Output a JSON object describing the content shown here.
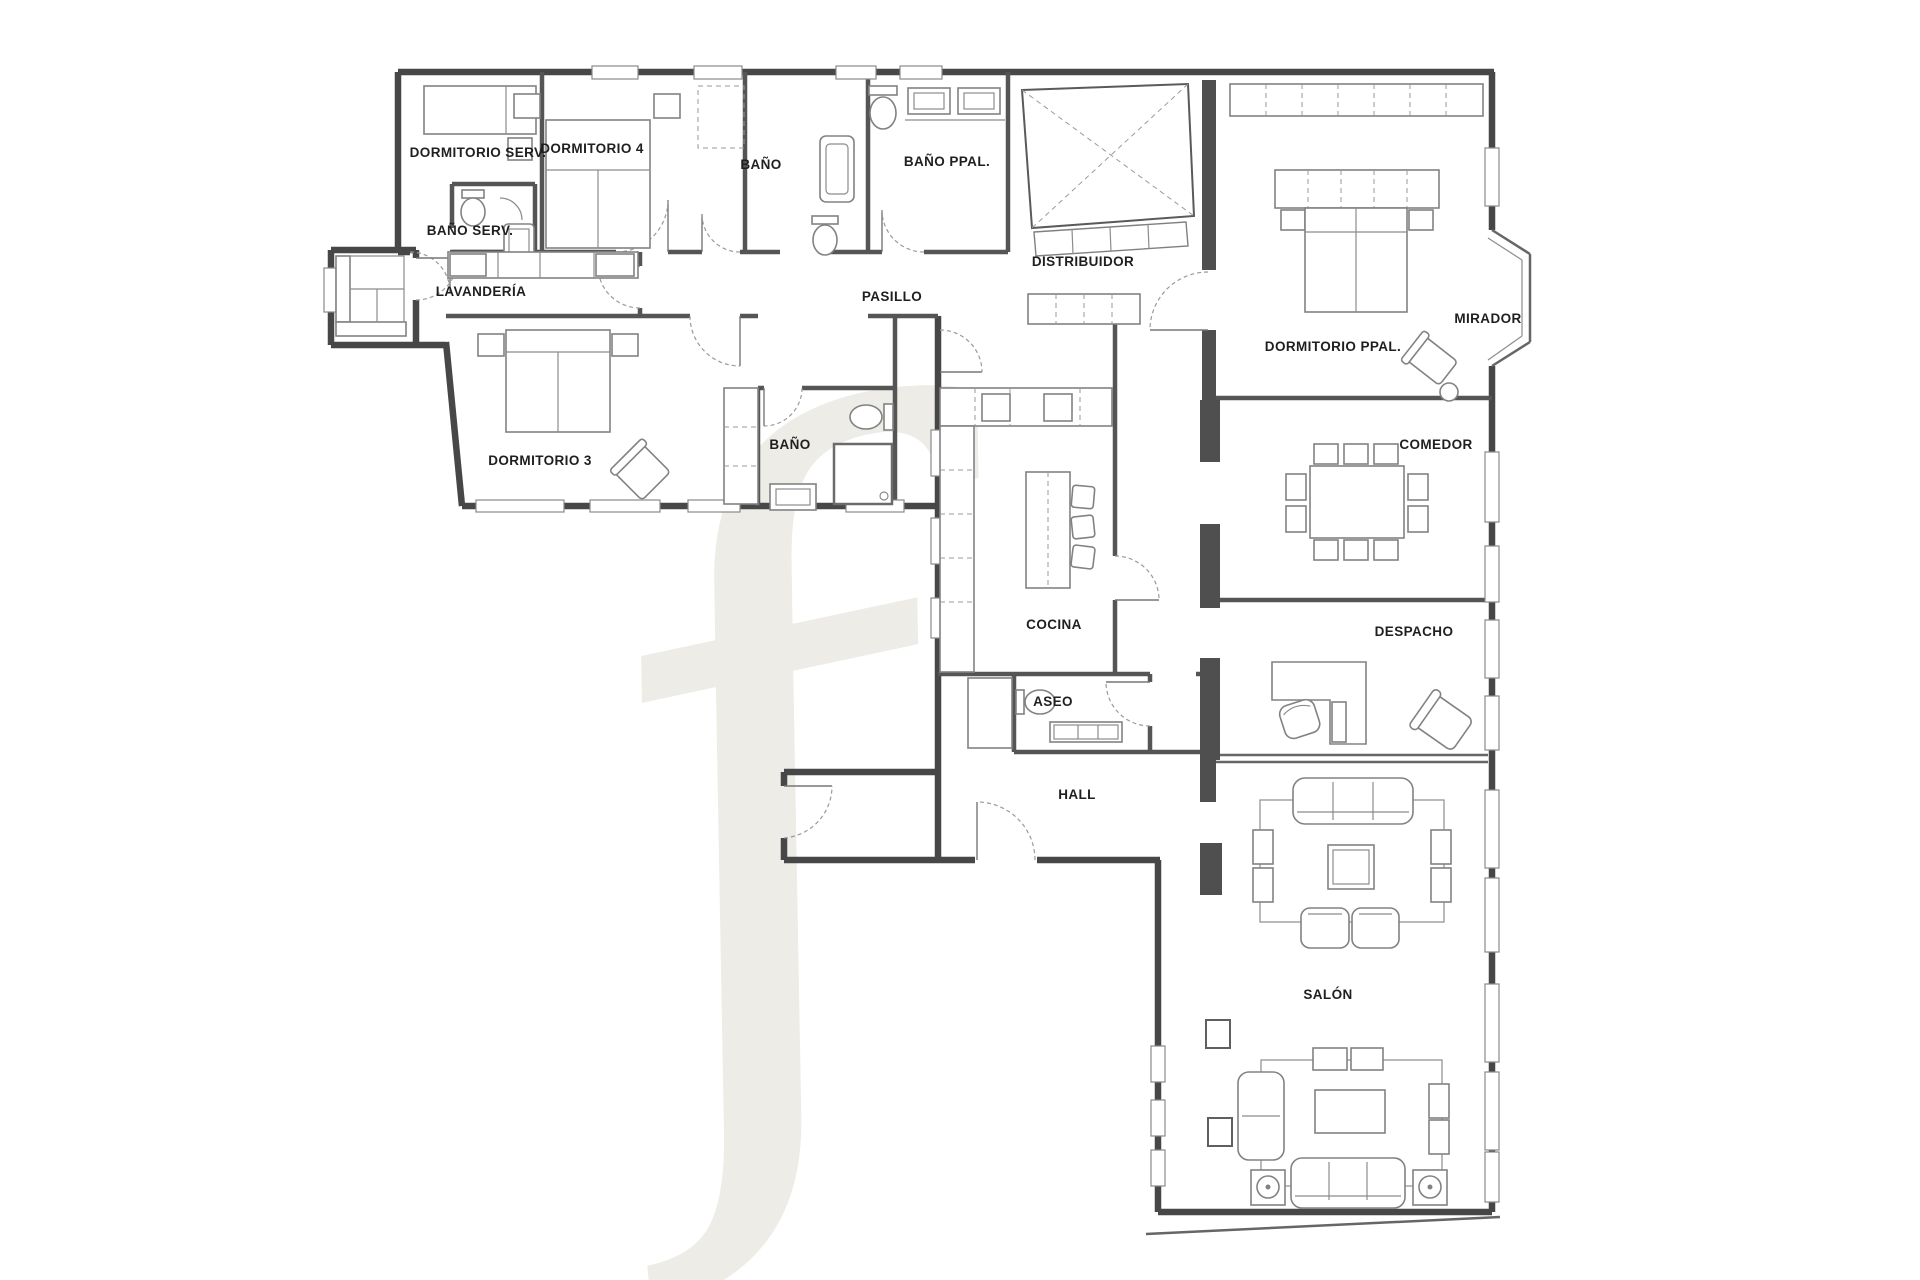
{
  "plan": {
    "type": "apartment-floor-plan",
    "language": "es",
    "colors": {
      "background": "#ffffff",
      "wall": "#474747",
      "interior_wall": "#555555",
      "furniture_line": "#828282",
      "door_arc": "#9a9a9a",
      "label": "#1f1f1f",
      "watermark": "#edece7"
    },
    "watermark": {
      "glyph": "f"
    },
    "rooms": [
      {
        "id": "dormitorio-serv",
        "label": "DORMITORIO  SERV."
      },
      {
        "id": "dormitorio-4",
        "label": "DORMITORIO  4"
      },
      {
        "id": "bano-serv",
        "label": "BAÑO SERV."
      },
      {
        "id": "bano",
        "label": "BAÑO"
      },
      {
        "id": "bano-ppal",
        "label": "BAÑO PPAL."
      },
      {
        "id": "distribuidor",
        "label": "DISTRIBUIDOR"
      },
      {
        "id": "dormitorio-ppal",
        "label": "DORMITORIO  PPAL."
      },
      {
        "id": "mirador",
        "label": "MIRADOR"
      },
      {
        "id": "lavanderia",
        "label": "LAVANDERÍA"
      },
      {
        "id": "pasillo",
        "label": "PASILLO"
      },
      {
        "id": "dormitorio-3",
        "label": "DORMITORIO  3"
      },
      {
        "id": "bano-2",
        "label": "BAÑO"
      },
      {
        "id": "cocina",
        "label": "COCINA"
      },
      {
        "id": "comedor",
        "label": "COMEDOR"
      },
      {
        "id": "despacho",
        "label": "DESPACHO"
      },
      {
        "id": "aseo",
        "label": "ASEO"
      },
      {
        "id": "hall",
        "label": "HALL"
      },
      {
        "id": "salon",
        "label": "SALÓN"
      }
    ]
  }
}
